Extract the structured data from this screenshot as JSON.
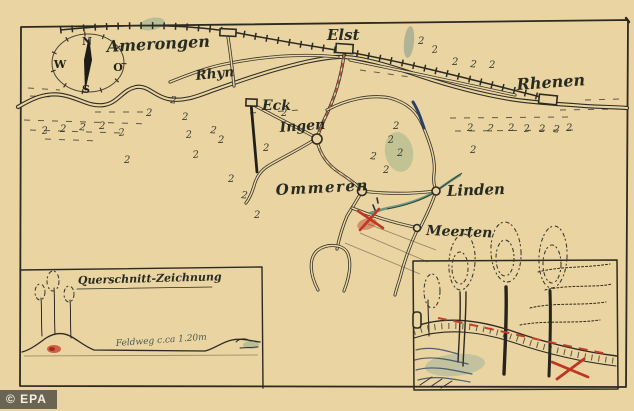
{
  "image_type": "photograph of a hand-drawn treasure map",
  "watermark": "© EPA",
  "compass": {
    "north": "N",
    "east": "O",
    "south": "S",
    "west": "W"
  },
  "map": {
    "river_label": "Rhyn",
    "scatter_symbol": "2",
    "places": {
      "amerongen": "Amerongen",
      "elst": "Elst",
      "rhenen": "Rhenen",
      "eck": "Eck",
      "ingen": "Ingen",
      "ommeren": "Ommeren",
      "linden": "Linden",
      "meerten": "Meerten"
    }
  },
  "insets": {
    "cross_section": {
      "title": "Querschnitt-Zeichnung",
      "path_label": "Feldweg c.ca 1.20m"
    }
  },
  "colors": {
    "paper": "#e9d4a2",
    "ink": "#2c2a21",
    "red_mark": "#c03a26",
    "teal_wash": "#5a9a88",
    "blue_ink": "#2c3f66"
  }
}
